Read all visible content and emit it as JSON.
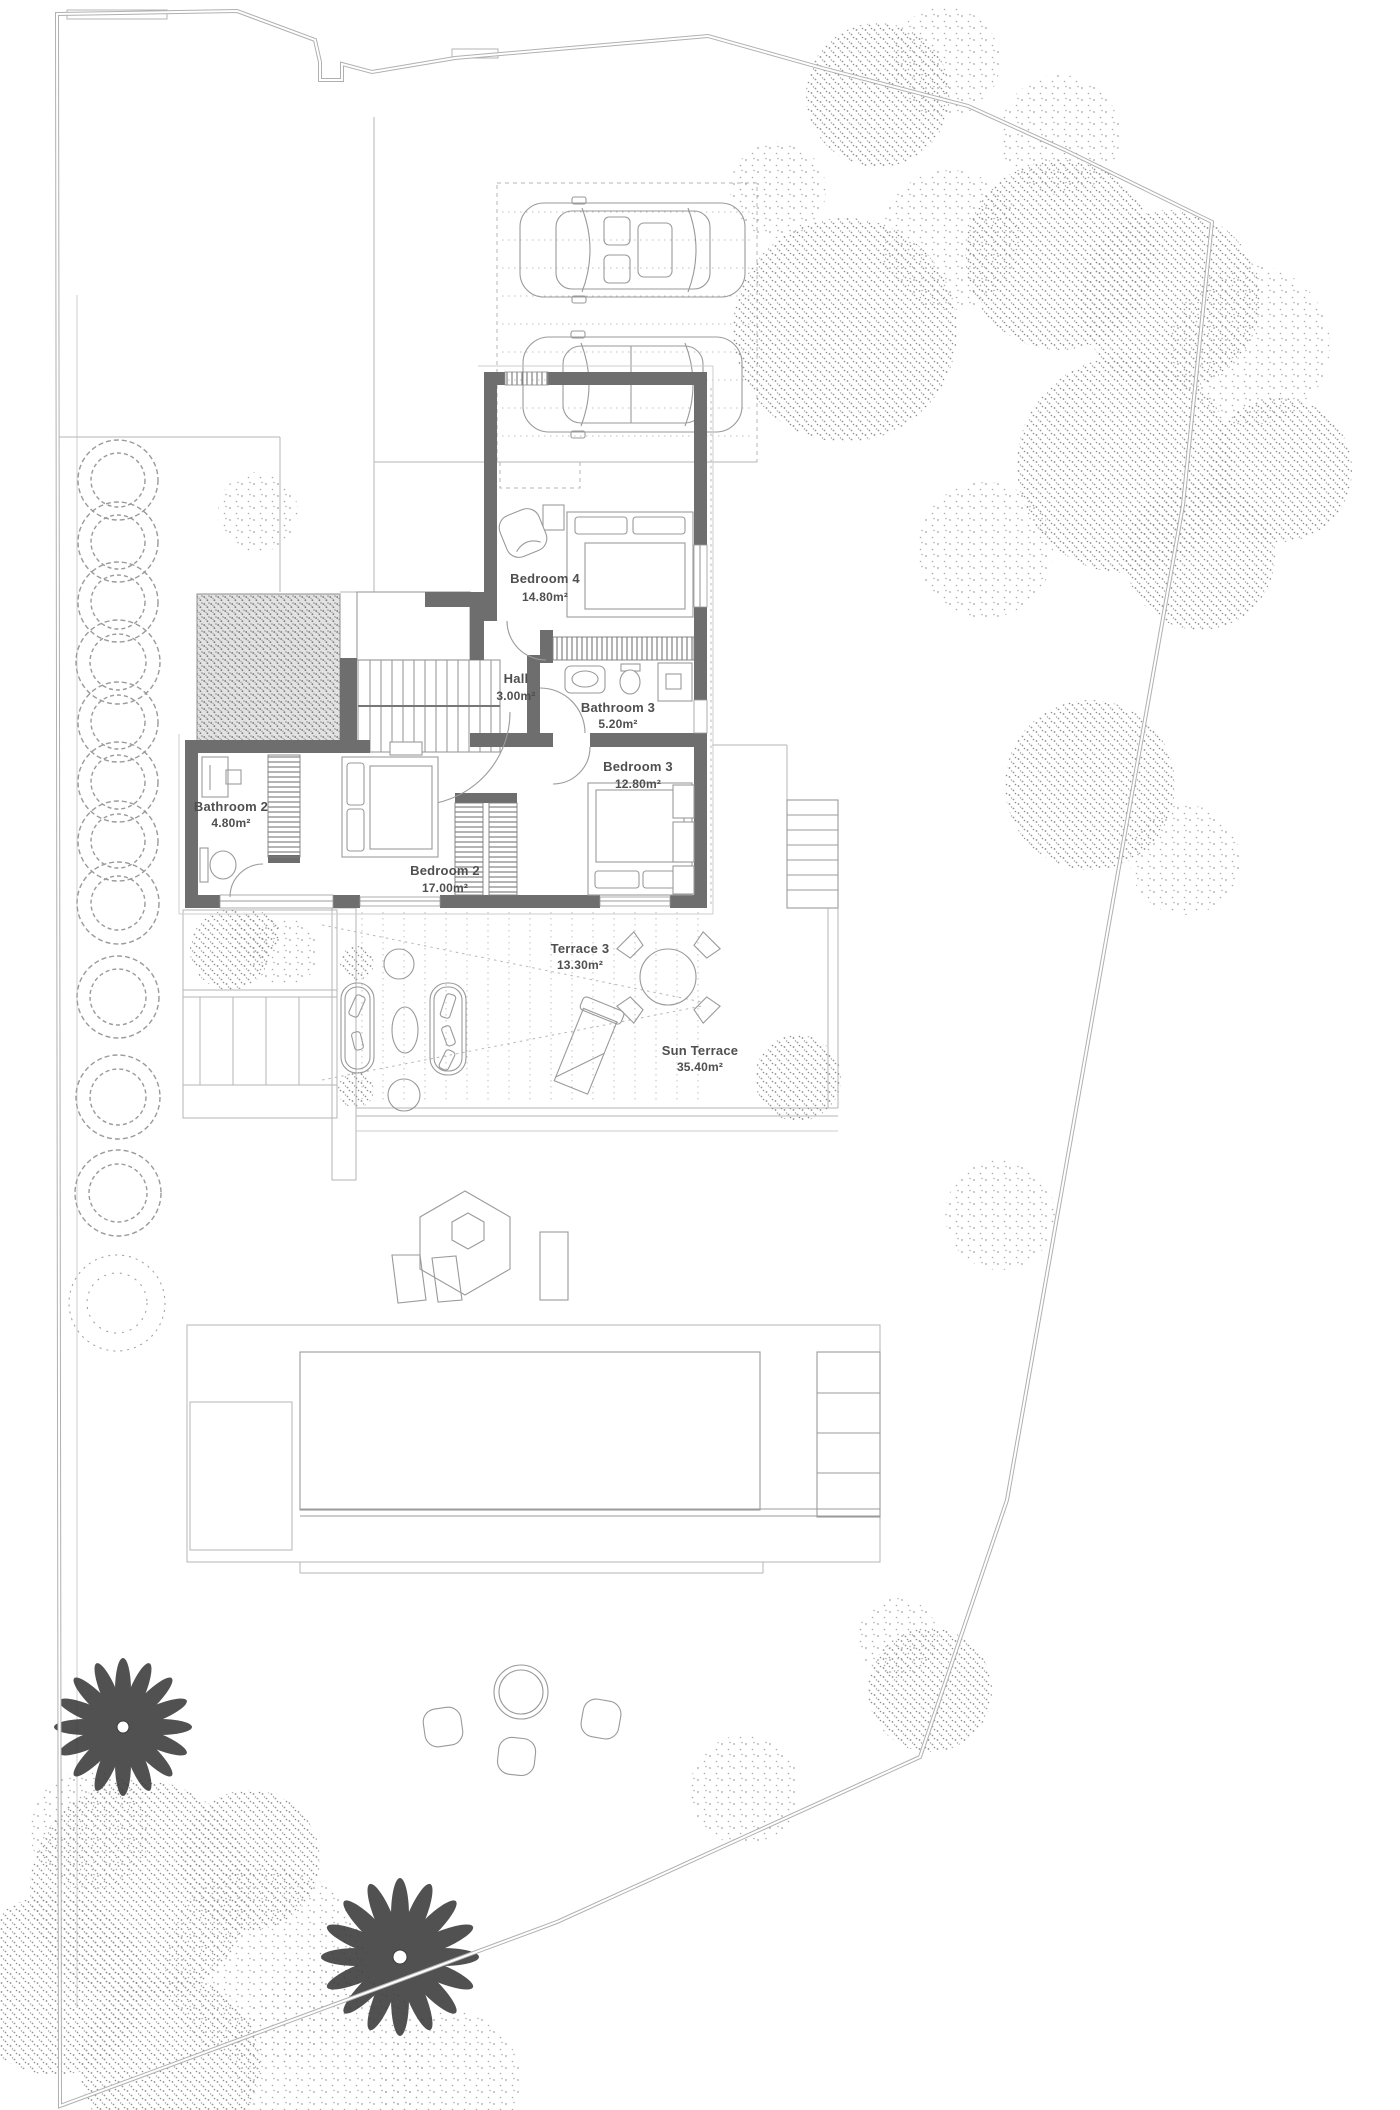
{
  "plan": {
    "rooms": {
      "bedroom4": {
        "name": "Bedroom 4",
        "area": "14.80m²"
      },
      "hall": {
        "name": "Hall",
        "area": "3.00m²"
      },
      "bathroom3": {
        "name": "Bathroom 3",
        "area": "5.20m²"
      },
      "bedroom3": {
        "name": "Bedroom 3",
        "area": "12.80m²"
      },
      "bathroom2": {
        "name": "Bathroom 2",
        "area": "4.80m²"
      },
      "bedroom2": {
        "name": "Bedroom 2",
        "area": "17.00m²"
      },
      "terrace3": {
        "name": "Terrace 3",
        "area": "13.30m²"
      },
      "sun_terrace": {
        "name": "Sun Terrace",
        "area": "35.40m²"
      }
    },
    "colors": {
      "wall": "#6e6e6e",
      "line": "#9b9b9b",
      "boundary": "#b0b0b0",
      "label": "#4f4f4f",
      "foliage": "#8c8c8c",
      "palm": "#3a3a3a"
    }
  }
}
